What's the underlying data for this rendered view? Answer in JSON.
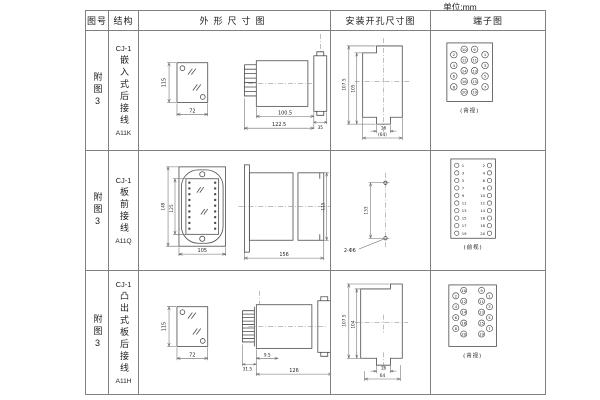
{
  "page": {
    "unit_label": "单位:mm"
  },
  "header": {
    "fig_no": "图号",
    "structure": "结构",
    "outline": "外形尺寸图",
    "mounting": "安装开孔尺寸图",
    "terminal": "端子图"
  },
  "rows": [
    {
      "fig_no": "附图3",
      "model": "CJ-1",
      "structure": "嵌入式后接线",
      "code": "A11K",
      "outline": {
        "front_h": "115",
        "front_w": "72",
        "body": "100.5",
        "total": "122.5",
        "flange": "35"
      },
      "mounting": {
        "outer_h": "107.5",
        "inner_h": "105",
        "slot": "16",
        "width": "(64)"
      },
      "terminal": {
        "caption": "(背视)",
        "layout": "staggered",
        "columns": [
          {
            "stagger": true,
            "numbers": [
              "2",
              "4",
              "6",
              "8"
            ]
          },
          {
            "stagger": false,
            "numbers": [
              "10",
              "12",
              "14",
              "16",
              "20"
            ]
          },
          {
            "stagger": false,
            "numbers": [
              "9",
              "11",
              "13",
              "15",
              "19"
            ]
          },
          {
            "stagger": true,
            "numbers": [
              "1",
              "3",
              "5",
              "7"
            ]
          }
        ]
      }
    },
    {
      "fig_no": "附图3",
      "model": "CJ-1",
      "structure": "板前接线",
      "code": "A11Q",
      "outline": {
        "front_h": "149",
        "inner_h": "125",
        "front_w": "105",
        "body_len": "156",
        "side_h": "115"
      },
      "mounting": {
        "spacing": "133",
        "holes": "2-Φ6"
      },
      "terminal": {
        "caption": "(前视)",
        "layout": "paired",
        "left": [
          "1",
          "3",
          "5",
          "7",
          "9",
          "11",
          "13",
          "15",
          "17",
          "19"
        ],
        "right": [
          "2",
          "4",
          "6",
          "8",
          "10",
          "12",
          "14",
          "16",
          "18",
          "20"
        ]
      }
    },
    {
      "fig_no": "附图3",
      "model": "CJ-1",
      "structure": "凸出式板后接线",
      "code": "A11H",
      "outline": {
        "front_h": "115",
        "front_w": "72",
        "pin_len": "9.5",
        "strip": "31.5",
        "body_len": "126"
      },
      "mounting": {
        "outer_h": "107.5",
        "inner_h": "104",
        "slot": "16",
        "width": "64"
      },
      "terminal": {
        "caption": "(背视)",
        "layout": "staggered",
        "columns": [
          {
            "stagger": true,
            "numbers": [
              "2",
              "4",
              "6",
              "8"
            ]
          },
          {
            "stagger": false,
            "numbers": [
              "10",
              "12",
              "14",
              "16",
              "20"
            ]
          },
          {
            "stagger": false,
            "numbers": [
              "9",
              "11",
              "13",
              "15",
              "19"
            ]
          },
          {
            "stagger": true,
            "numbers": [
              "1",
              "3",
              "5",
              "7"
            ]
          }
        ]
      }
    }
  ]
}
